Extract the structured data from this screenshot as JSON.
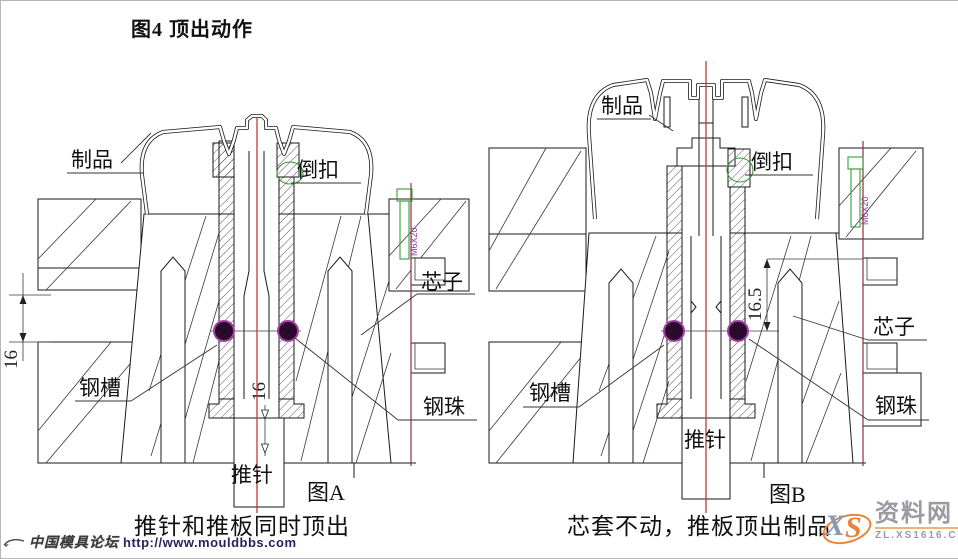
{
  "title": "图4 顶出动作",
  "figures": [
    {
      "tag": "图A",
      "caption": "推针和推板同时顶出",
      "labels": {
        "product": "制品",
        "undercut": "倒扣",
        "core": "芯子",
        "ball": "钢珠",
        "groove": "钢槽",
        "pin": "推针"
      },
      "dims": {
        "plate_gap": "16",
        "pin_travel": "16"
      },
      "screw": "M6X20"
    },
    {
      "tag": "图B",
      "caption": "芯套不动，推板顶出制品",
      "labels": {
        "product": "制品",
        "undercut": "倒扣",
        "core": "芯子",
        "ball": "钢珠",
        "groove": "钢槽",
        "pin": "推针"
      },
      "dims": {
        "pin_travel": "16.5"
      },
      "screw": "M6X20"
    }
  ],
  "watermarks": {
    "forum_name": "中国模具论坛",
    "forum_url": "http://www.mouldbbs.com",
    "site_logo_x": "X",
    "site_logo_s": "S",
    "site_name": "资料网",
    "site_domain": "ZL.XS1616.COM"
  },
  "colors": {
    "centerline": "#c03a3a",
    "boundary": "#8c2f3f",
    "steel_ball": "#2b0b2b",
    "steel_ball_ring": "#a33fa3",
    "screw": "#3a9a3a",
    "screw_label": "#993399",
    "logo_orange": "#e8833a",
    "logo_gray": "#9a9aa2"
  }
}
